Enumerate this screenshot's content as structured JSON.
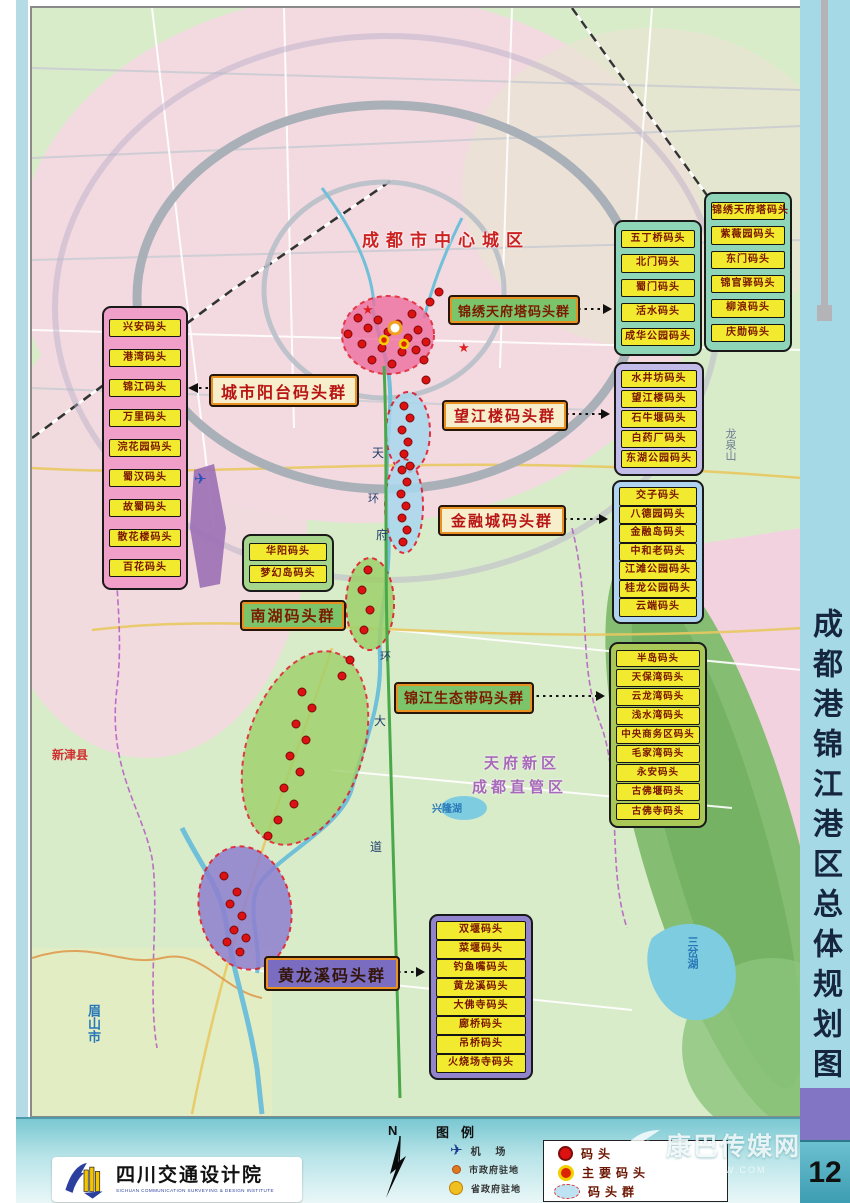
{
  "page": {
    "vertical_title": "成都港锦江港区总体规划图",
    "page_number": "12"
  },
  "map_labels": {
    "center_city": "成都市中心城区",
    "tianfu_line1": "天府新区",
    "tianfu_line2": "成都直管区",
    "xinglong_lake": "兴隆湖",
    "sancha_lake": "三岔湖",
    "jianyang": "简阳市",
    "xinjin": "新津县",
    "meishan": "眉山市",
    "longquan": "龙泉山",
    "airport": "国际机场",
    "avenue_chars": [
      "天",
      "府",
      "大",
      "道"
    ],
    "ring_char": "环"
  },
  "groups": {
    "city_balcony": {
      "label": "城市阳台码头群",
      "docks": [
        "兴安码头",
        "港湾码头",
        "锦江码头",
        "万里码头",
        "浣花园码头",
        "蜀汉码头",
        "故蜀码头",
        "散花楼码头",
        "百花码头"
      ]
    },
    "jinxiu_tower": {
      "label": "锦绣天府塔码头群",
      "docks_left": [
        "五丁桥码头",
        "北门码头",
        "蜀门码头",
        "活水码头",
        "成华公园码头"
      ],
      "docks_right": [
        "锦绣天府塔码头",
        "紫薇园码头",
        "东门码头",
        "锦官驿码头",
        "柳浪码头",
        "庆勋码头"
      ]
    },
    "wangjiang_tower": {
      "label": "望江楼码头群",
      "docks": [
        "水井坊码头",
        "望江楼码头",
        "石牛堰码头",
        "白药厂码头",
        "东湖公园码头"
      ]
    },
    "financial_city": {
      "label": "金融城码头群",
      "docks": [
        "交子码头",
        "八德园码头",
        "金融岛码头",
        "中和老码头",
        "江滩公园码头",
        "桂龙公园码头",
        "云端码头"
      ]
    },
    "south_lake": {
      "label": "南湖码头群",
      "docks": [
        "华阳码头",
        "梦幻岛码头"
      ]
    },
    "eco_belt": {
      "label": "锦江生态带码头群",
      "docks": [
        "半岛码头",
        "天保湾码头",
        "云龙湾码头",
        "浅水湾码头",
        "中央商务区码头",
        "毛家湾码头",
        "永安码头",
        "古佛堰码头",
        "古佛寺码头"
      ]
    },
    "huanglongxi": {
      "label": "黄龙溪码头群",
      "docks": [
        "双堰码头",
        "菜堰码头",
        "钓鱼嘴码头",
        "黄龙溪码头",
        "大佛寺码头",
        "廊桥码头",
        "吊桥码头",
        "火烧场寺码头"
      ]
    }
  },
  "map_points": {
    "docks": [
      [
        326,
        310
      ],
      [
        336,
        320
      ],
      [
        346,
        312
      ],
      [
        356,
        324
      ],
      [
        366,
        316
      ],
      [
        376,
        330
      ],
      [
        386,
        322
      ],
      [
        330,
        336
      ],
      [
        350,
        340
      ],
      [
        370,
        344
      ],
      [
        384,
        342
      ],
      [
        394,
        334
      ],
      [
        340,
        352
      ],
      [
        360,
        356
      ],
      [
        380,
        306
      ],
      [
        316,
        326
      ],
      [
        392,
        352
      ],
      [
        398,
        294
      ],
      [
        407,
        284
      ],
      [
        372,
        398
      ],
      [
        378,
        410
      ],
      [
        370,
        422
      ],
      [
        376,
        434
      ],
      [
        372,
        446
      ],
      [
        378,
        458
      ],
      [
        394,
        372
      ],
      [
        370,
        462
      ],
      [
        375,
        474
      ],
      [
        369,
        486
      ],
      [
        374,
        498
      ],
      [
        370,
        510
      ],
      [
        375,
        522
      ],
      [
        371,
        534
      ],
      [
        336,
        562
      ],
      [
        330,
        582
      ],
      [
        338,
        602
      ],
      [
        332,
        622
      ],
      [
        318,
        652
      ],
      [
        310,
        668
      ],
      [
        270,
        684
      ],
      [
        280,
        700
      ],
      [
        264,
        716
      ],
      [
        274,
        732
      ],
      [
        258,
        748
      ],
      [
        268,
        764
      ],
      [
        252,
        780
      ],
      [
        262,
        796
      ],
      [
        246,
        812
      ],
      [
        236,
        828
      ],
      [
        192,
        868
      ],
      [
        205,
        884
      ],
      [
        198,
        896
      ],
      [
        210,
        908
      ],
      [
        202,
        922
      ],
      [
        195,
        934
      ],
      [
        208,
        944
      ],
      [
        214,
        930
      ]
    ],
    "main_docks": [
      [
        352,
        332
      ],
      [
        372,
        336
      ]
    ],
    "gov_circle": [
      363,
      320
    ]
  },
  "legend": {
    "title": "图例",
    "north_label": "N",
    "left_items": [
      {
        "icon": "airplane-icon",
        "label": "机    场"
      },
      {
        "icon": "city-gov-dot",
        "label": "市政府驻地"
      },
      {
        "icon": "province-gov-dot",
        "label": "省政府驻地"
      }
    ],
    "boxed_items": [
      {
        "icon": "dock-dot",
        "label": "码头"
      },
      {
        "icon": "main-dock-dot",
        "label": "主要码头"
      },
      {
        "icon": "dock-cluster-ellipse",
        "label": "码头群"
      }
    ]
  },
  "footer": {
    "logo_cn": "四川交通设计院",
    "logo_en": "SICHUAN COMMUNICATION SURVEYING & DESIGN INSTITUTE",
    "watermark_text": "康巴传媒网",
    "watermark_sub": "WWW.KBCMW.COM"
  },
  "palette": {
    "dock_label_bg": "#f2ea2e",
    "dock_dot_red": "#dd1111",
    "main_dock_orange": "#f2d000",
    "cluster_pink": "#ee6fa0",
    "cluster_blue": "#a8d8ef",
    "cluster_green": "#9ed06a",
    "cluster_purple": "#8f7fd0",
    "strip_blue": "#a5d9e6",
    "page_num_teal": "#3d9db2",
    "purple_block": "#8276c4"
  }
}
